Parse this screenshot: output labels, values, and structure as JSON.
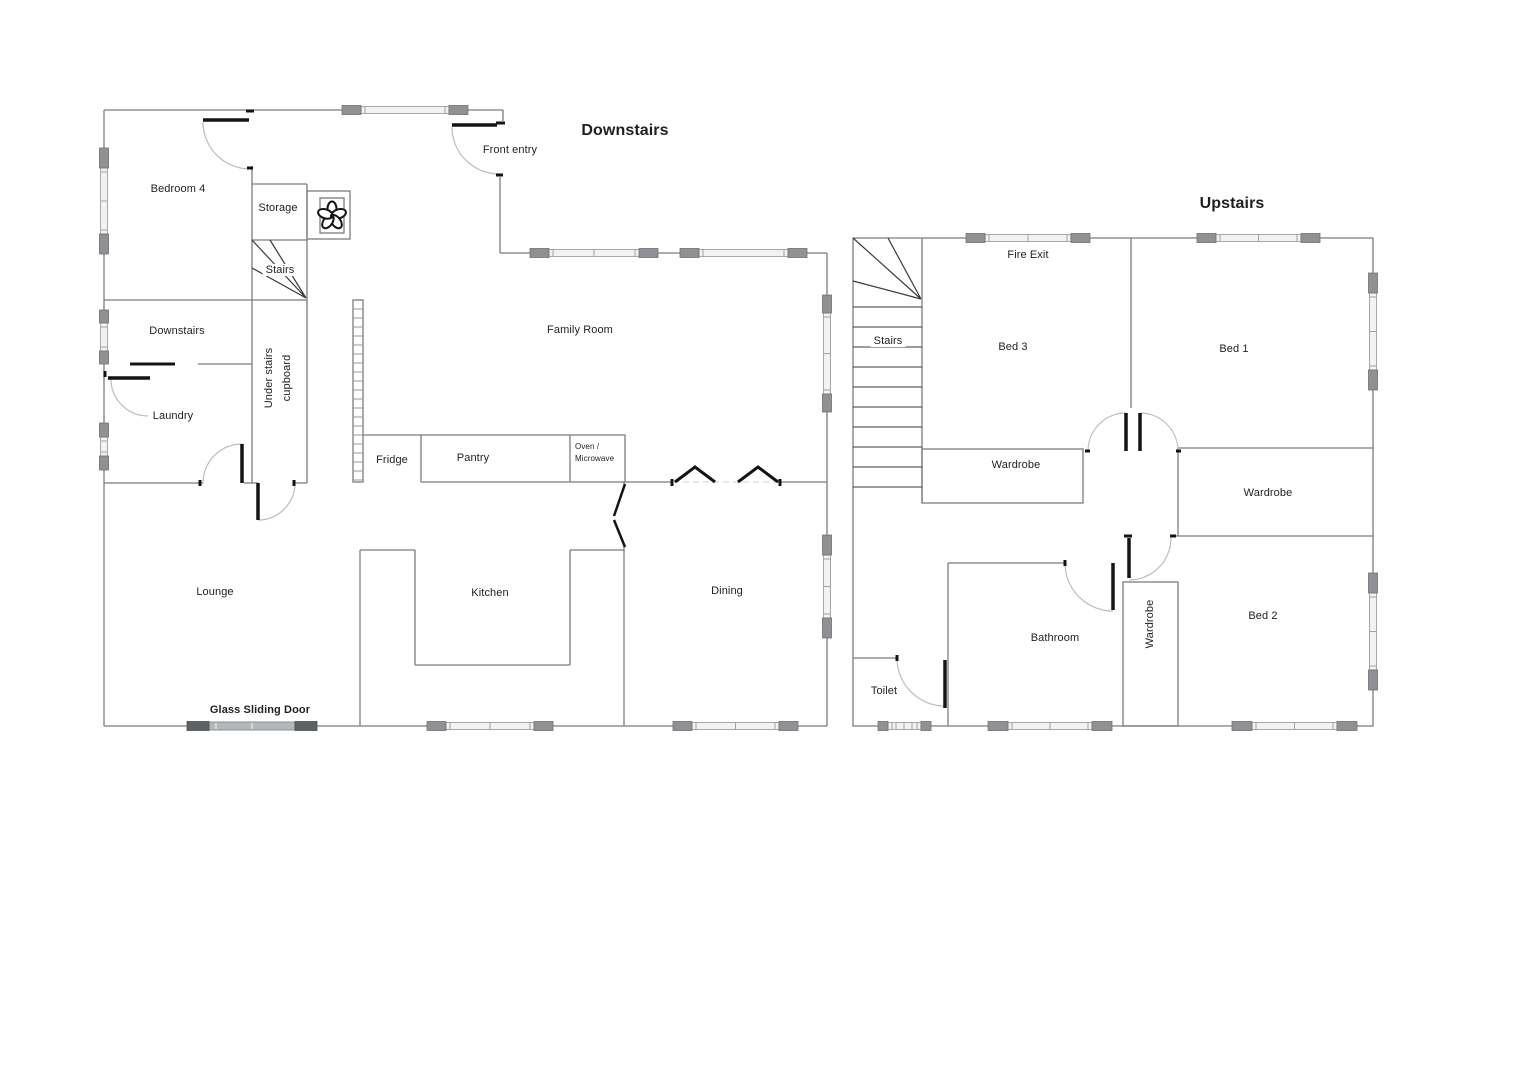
{
  "colors": {
    "wall": "#7c7c7c",
    "door": "#141414",
    "swing_arc": "#bcbcbc",
    "window_cap": "#8f9194",
    "window_glass": "#f2f2f2",
    "slider_cap": "#5d6065",
    "slider_glass": "#b4b8bc",
    "text": "#1f1f1f"
  },
  "downstairs": {
    "title": "Downstairs",
    "labels": {
      "bedroom4": "Bedroom 4",
      "storage": "Storage",
      "stairs": "Stairs",
      "hall": "Downstairs",
      "under_stairs_line1": "Under stairs",
      "under_stairs_line2": "cupboard",
      "laundry": "Laundry",
      "front_entry": "Front entry",
      "family_room": "Family Room",
      "fridge": "Fridge",
      "pantry": "Pantry",
      "oven_line1": "Oven /",
      "oven_line2": "Microwave",
      "lounge": "Lounge",
      "kitchen": "Kitchen",
      "dining": "Dining",
      "glass_sliding_door": "Glass Sliding Door"
    }
  },
  "upstairs": {
    "title": "Upstairs",
    "labels": {
      "fire_exit": "Fire Exit",
      "stairs": "Stairs",
      "bed3": "Bed 3",
      "bed1": "Bed 1",
      "bed2": "Bed 2",
      "wardrobe_bed3": "Wardrobe",
      "wardrobe_bed1": "Wardrobe",
      "wardrobe_bed2": "Wardrobe",
      "bathroom": "Bathroom",
      "toilet": "Toilet"
    }
  }
}
